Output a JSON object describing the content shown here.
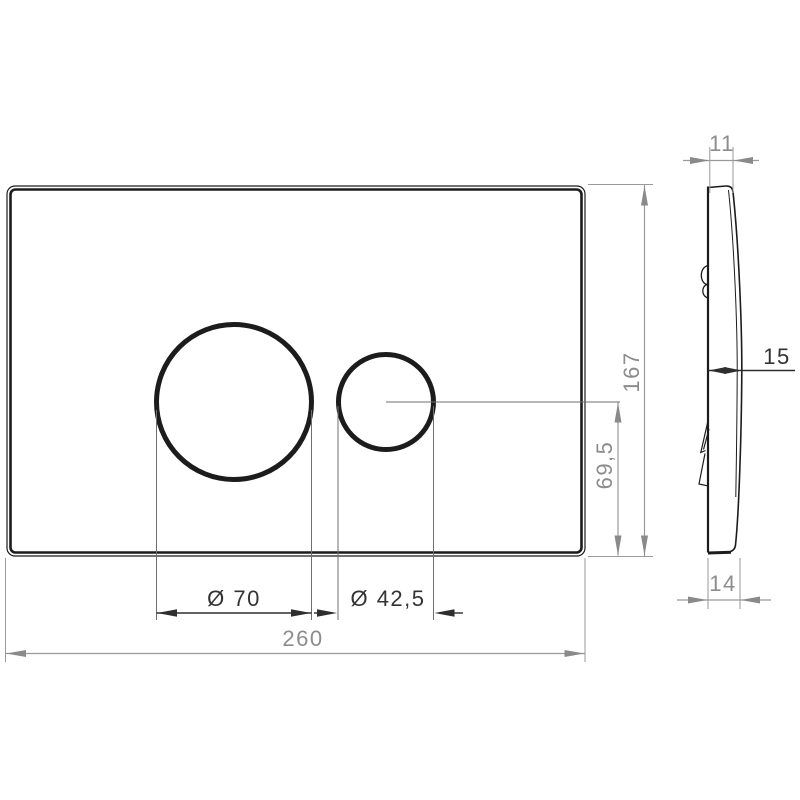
{
  "drawing_type": "technical-drawing-flush-plate",
  "front_view": {
    "width_dim": "260",
    "height_dim": "167",
    "large_diameter_dim": "Ø 70",
    "small_diameter_dim": "Ø 42,5",
    "center_height_dim": "69,5"
  },
  "side_view": {
    "top_thickness_dim": "11",
    "mid_thickness_dim": "15",
    "bottom_thickness_dim": "14"
  },
  "colors": {
    "background": "#ffffff",
    "outline_dark": "#1c1c1c",
    "dimension_dark": "#333333",
    "dimension_gray": "#8c8c8c"
  }
}
